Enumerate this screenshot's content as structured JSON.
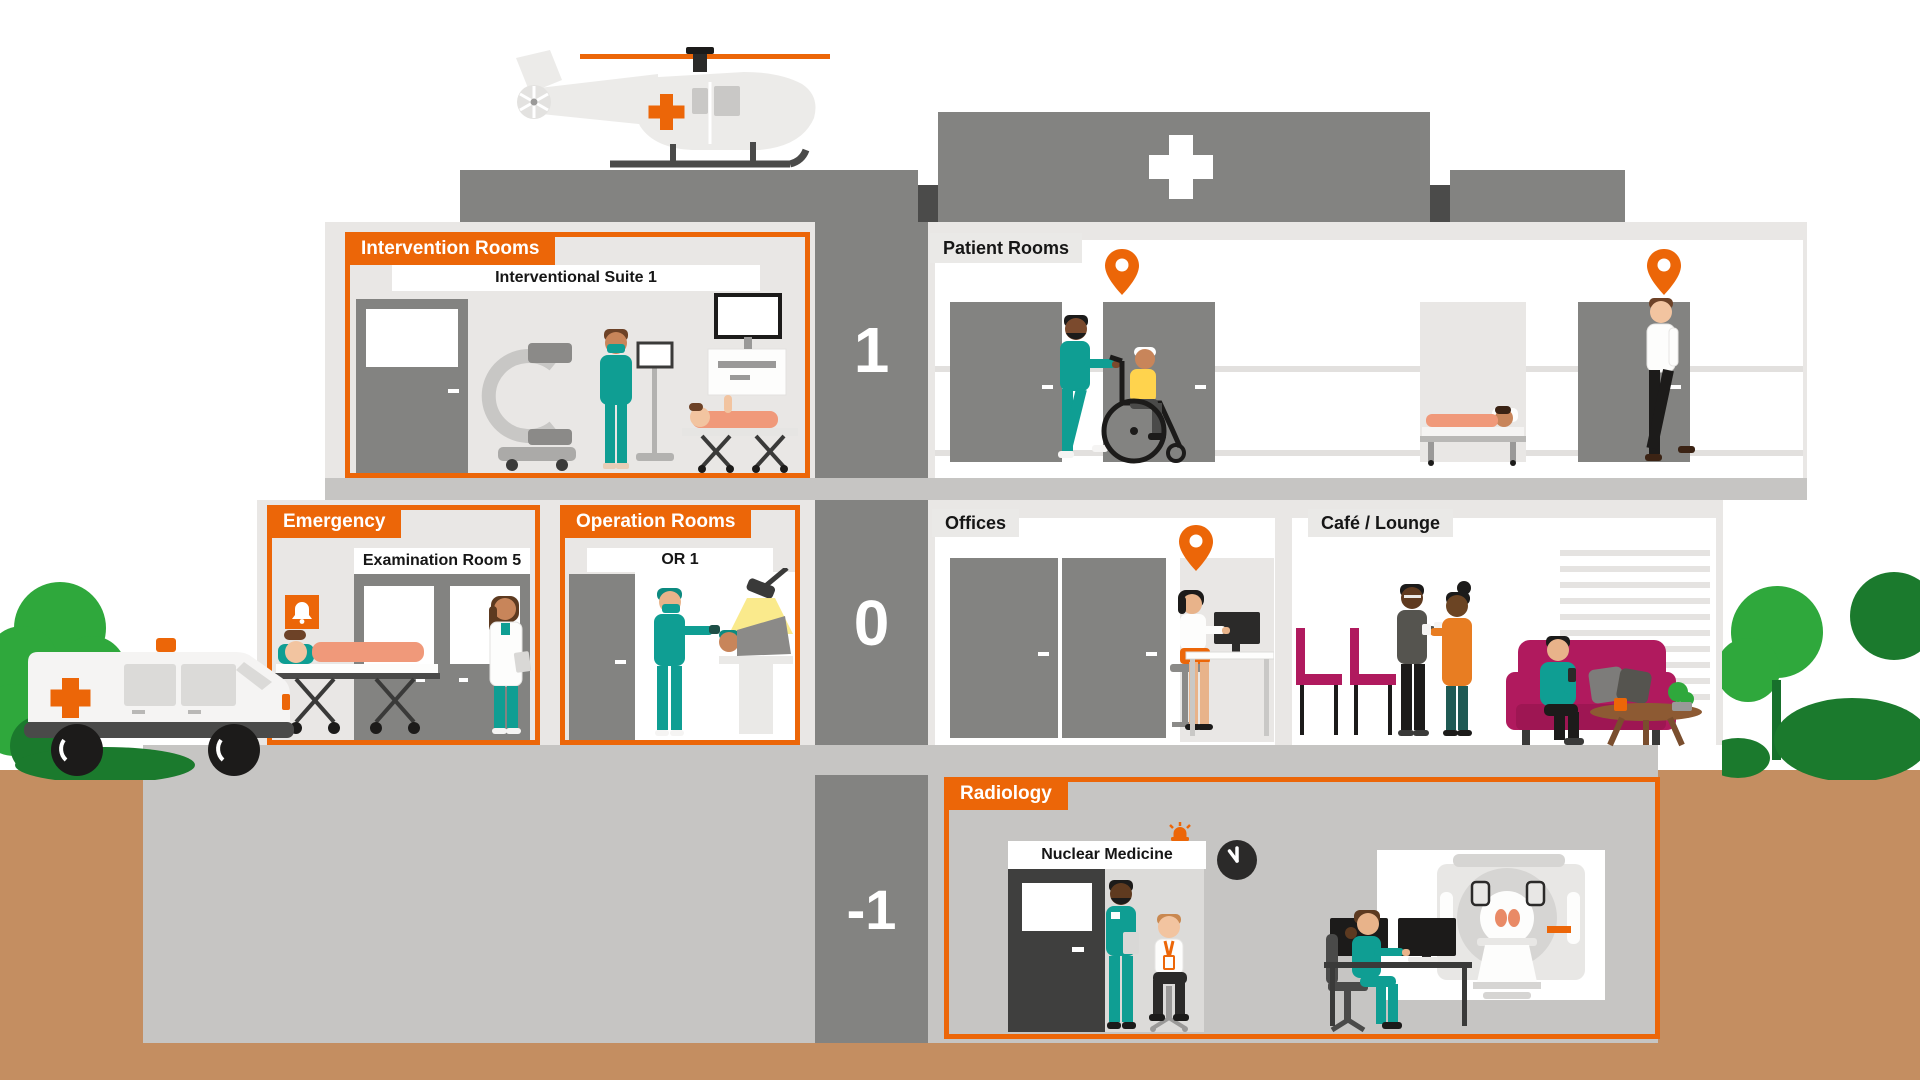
{
  "title": "Hospital cross-section map",
  "floors": [
    {
      "number": "1"
    },
    {
      "number": "0"
    },
    {
      "number": "-1"
    }
  ],
  "rooms": {
    "intervention": {
      "title": "Intervention Rooms",
      "sublabel": "Interventional Suite 1"
    },
    "patient_rooms": {
      "title": "Patient Rooms"
    },
    "emergency": {
      "title": "Emergency",
      "sublabel": "Examination Room 5"
    },
    "operation": {
      "title": "Operation Rooms",
      "sublabel": "OR 1"
    },
    "offices": {
      "title": "Offices"
    },
    "cafe": {
      "title": "Café / Lounge"
    },
    "radiology": {
      "title": "Radiology",
      "sublabel": "Nuclear Medicine"
    }
  },
  "icons": {
    "location_pin": "map-pin",
    "alarm_bell": "bell",
    "emergency_beacon": "siren-light",
    "wall_clock": "clock",
    "hospital_cross": "plus-cross",
    "helicopter": "medical-helicopter",
    "ambulance": "ambulance-van"
  },
  "palette": {
    "accent_orange": "#EC6608",
    "building_gray": "#838381",
    "interior_light_gray": "#E9E7E5",
    "slab_gray": "#C6C5C3",
    "earth_brown": "#C48E61",
    "scrubs_teal": "#0F9E93",
    "upholstery_magenta": "#B01A5E",
    "tree_green_light": "#2FA83C",
    "tree_green_dark": "#1B7A2D",
    "charcoal": "#3F3F3E"
  }
}
